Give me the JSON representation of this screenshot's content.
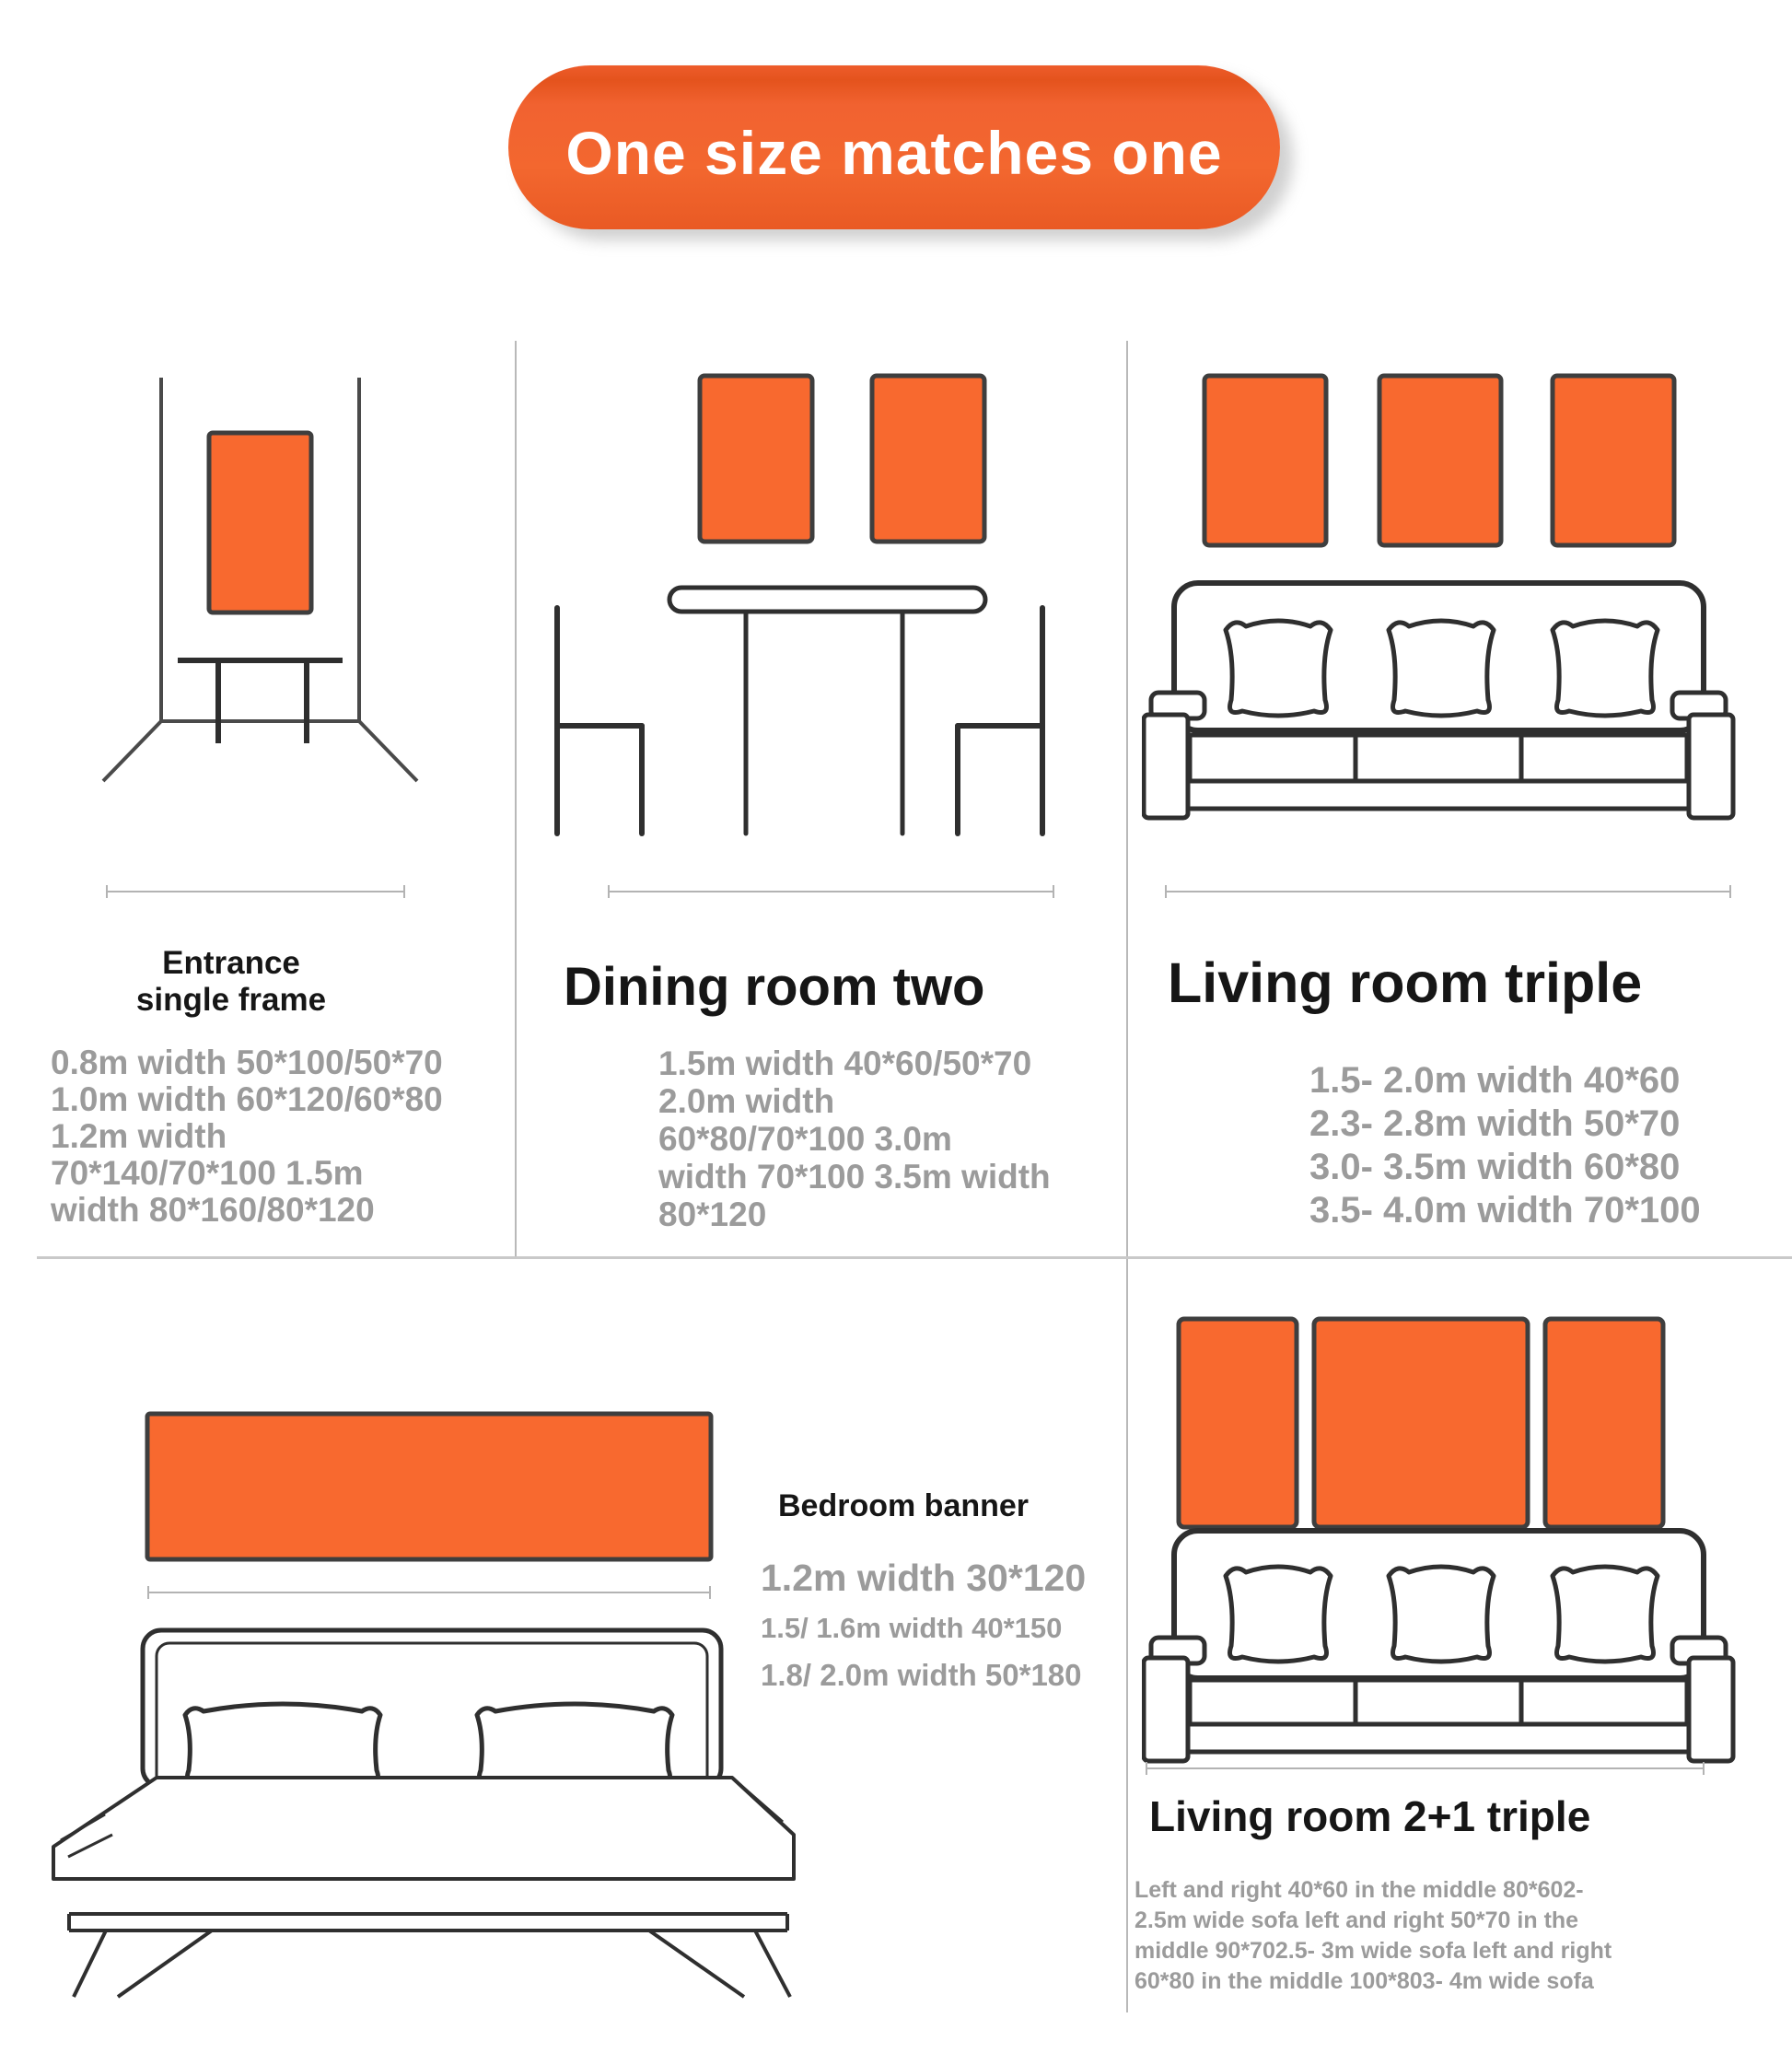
{
  "banner": {
    "label": "One size matches one"
  },
  "colors": {
    "accent_orange": "#F8692F",
    "pill_orange": "#F1612C",
    "title_black": "#161616",
    "body_gray": "#9B9B9B",
    "line_gray": "#B3B3B3"
  },
  "sections": {
    "entrance": {
      "title_line1": "Entrance",
      "title_line2": "single frame",
      "lines": [
        "0.8m width 50*100/50*70",
        "1.0m width 60*120/60*80",
        "1.2m width",
        "70*140/70*100 1.5m",
        "width 80*160/80*120"
      ]
    },
    "dining": {
      "title": "Dining room two",
      "lines": [
        "1.5m width 40*60/50*70",
        "2.0m width",
        "60*80/70*100 3.0m",
        "width 70*100 3.5m width",
        "80*120"
      ]
    },
    "living_triple": {
      "title": "Living room triple",
      "lines": [
        "1.5- 2.0m width 40*60",
        "2.3- 2.8m width 50*70",
        "3.0- 3.5m width 60*80",
        "3.5- 4.0m width 70*100"
      ]
    },
    "bedroom": {
      "title": "Bedroom banner",
      "lines": [
        "1.2m width 30*120",
        "1.5/ 1.6m width 40*150",
        "1.8/ 2.0m width 50*180"
      ]
    },
    "living_2plus1": {
      "title": "Living room 2+1 triple",
      "lines": [
        "Left and right 40*60 in the middle 80*602-",
        "2.5m wide sofa left and right 50*70 in the",
        "middle 90*702.5- 3m wide sofa left and right",
        "60*80 in the middle 100*803- 4m wide sofa"
      ]
    }
  }
}
